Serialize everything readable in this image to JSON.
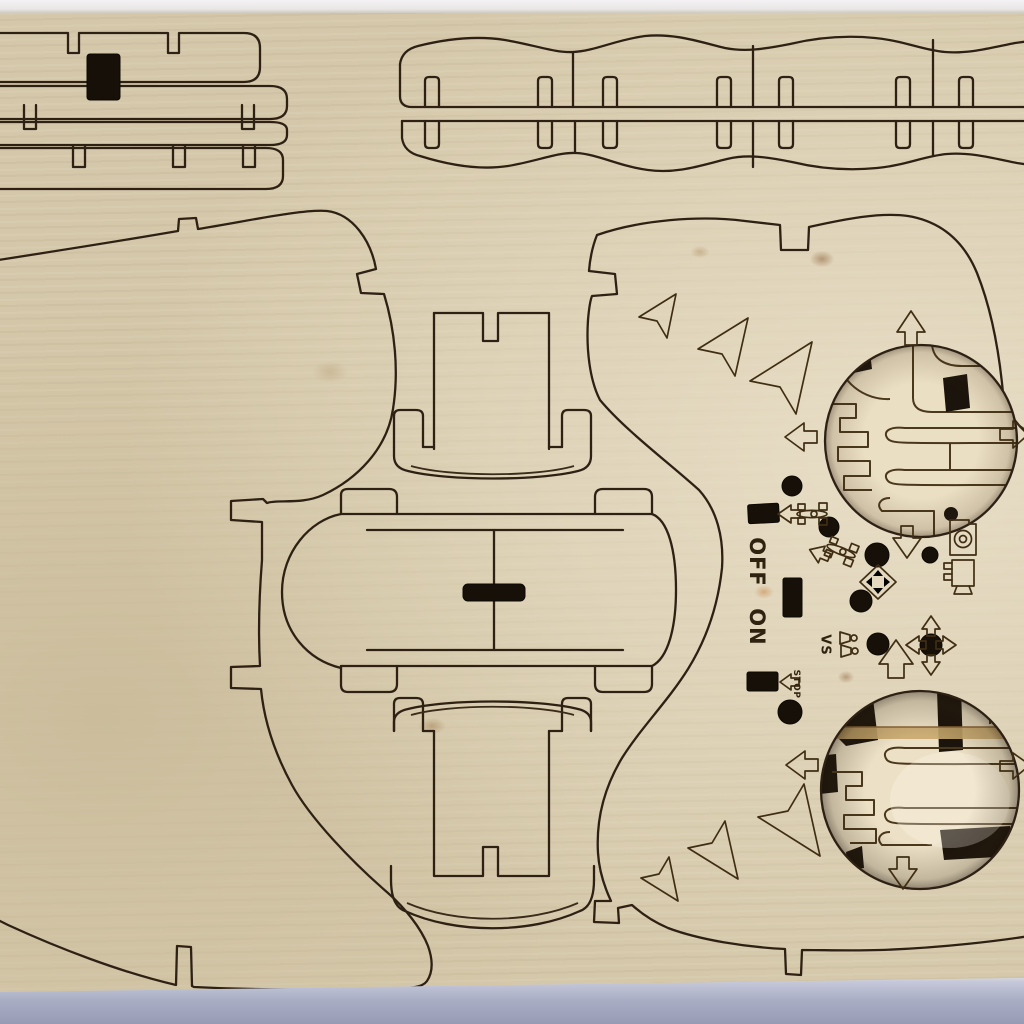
{
  "labels": {
    "power_off": "OFF",
    "power_on": "ON",
    "versus": "VS",
    "stop": "STOP"
  },
  "colors": {
    "backdrop_top": "#f1eff2",
    "wood": "#d5c8aa",
    "wood_light": "#e8dec6",
    "wood_dark": "#cbbd9c",
    "cut_line": "#2e2114",
    "engraving": "#3f2e14",
    "hole_black": "#171009",
    "sub_layer": "#eadfc4",
    "sub_layer_shadow": "#20180f",
    "grain_stain": "#c8a76b",
    "table_surface": "#a9adc4"
  },
  "icons": [
    "arrow-up-icon",
    "arrow-down-icon",
    "arrow-left-icon",
    "arrow-right-icon",
    "car-top-view-icon",
    "dpad-diamond-icon",
    "camera-icon",
    "projector-icon",
    "versus-players-icon",
    "chevron-triangle-icon"
  ]
}
